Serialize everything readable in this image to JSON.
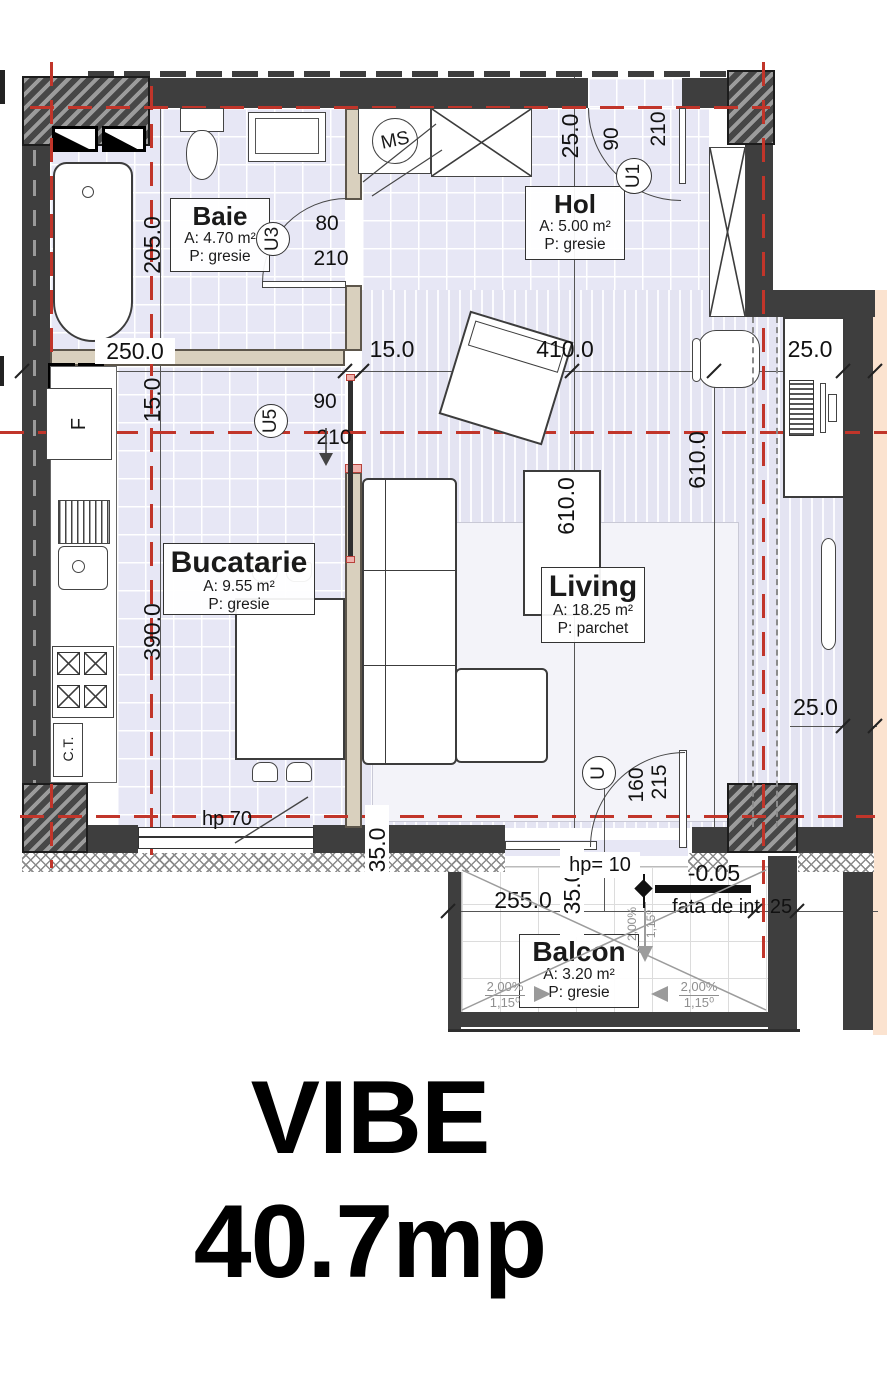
{
  "title": {
    "name": "VIBE",
    "area": "40.7mp"
  },
  "rooms": {
    "baie": {
      "name": "Baie",
      "area": "A: 4.70 m²",
      "floor": "P: gresie"
    },
    "hol": {
      "name": "Hol",
      "area": "A: 5.00 m²",
      "floor": "P: gresie"
    },
    "bucatarie": {
      "name": "Bucatarie",
      "area": "A: 9.55 m²",
      "floor": "P: gresie"
    },
    "living": {
      "name": "Living",
      "area": "A: 18.25 m²",
      "floor": "P: parchet"
    },
    "balcon": {
      "name": "Balcon",
      "area": "A: 3.20 m²",
      "floor": "P: gresie"
    }
  },
  "doors": {
    "u1": {
      "id": "U1",
      "w": "90",
      "h": "210"
    },
    "u3": {
      "id": "U3",
      "w": "80",
      "h": "210"
    },
    "u5": {
      "id": "U5",
      "w": "90",
      "h": "210"
    },
    "u": {
      "id": "U",
      "w": "160",
      "h": "215"
    }
  },
  "dims": {
    "top": {
      "d250": "250.0",
      "d15": "15.0",
      "d410": "410.0",
      "d25": "25.0"
    },
    "vert": {
      "baie": "205.0",
      "axis15": "15.0",
      "kitchen": "390.0",
      "hol": "25.0",
      "living1": "610.0",
      "living2": "610.0"
    },
    "right25": "25.0",
    "balcony": {
      "w": "255.0",
      "h": "35.0",
      "r": "25"
    },
    "wallT": "35.0",
    "hpWindow": "hp 70",
    "hpBalcony": "hp= 10",
    "level": "-0.05",
    "levelLabel": "fata de int",
    "slopePct": "2,00%",
    "slopeDeg": "1,15⁰"
  },
  "fixtures": {
    "washingMachine": "MS",
    "fridge": "F",
    "boiler": "C.T."
  }
}
